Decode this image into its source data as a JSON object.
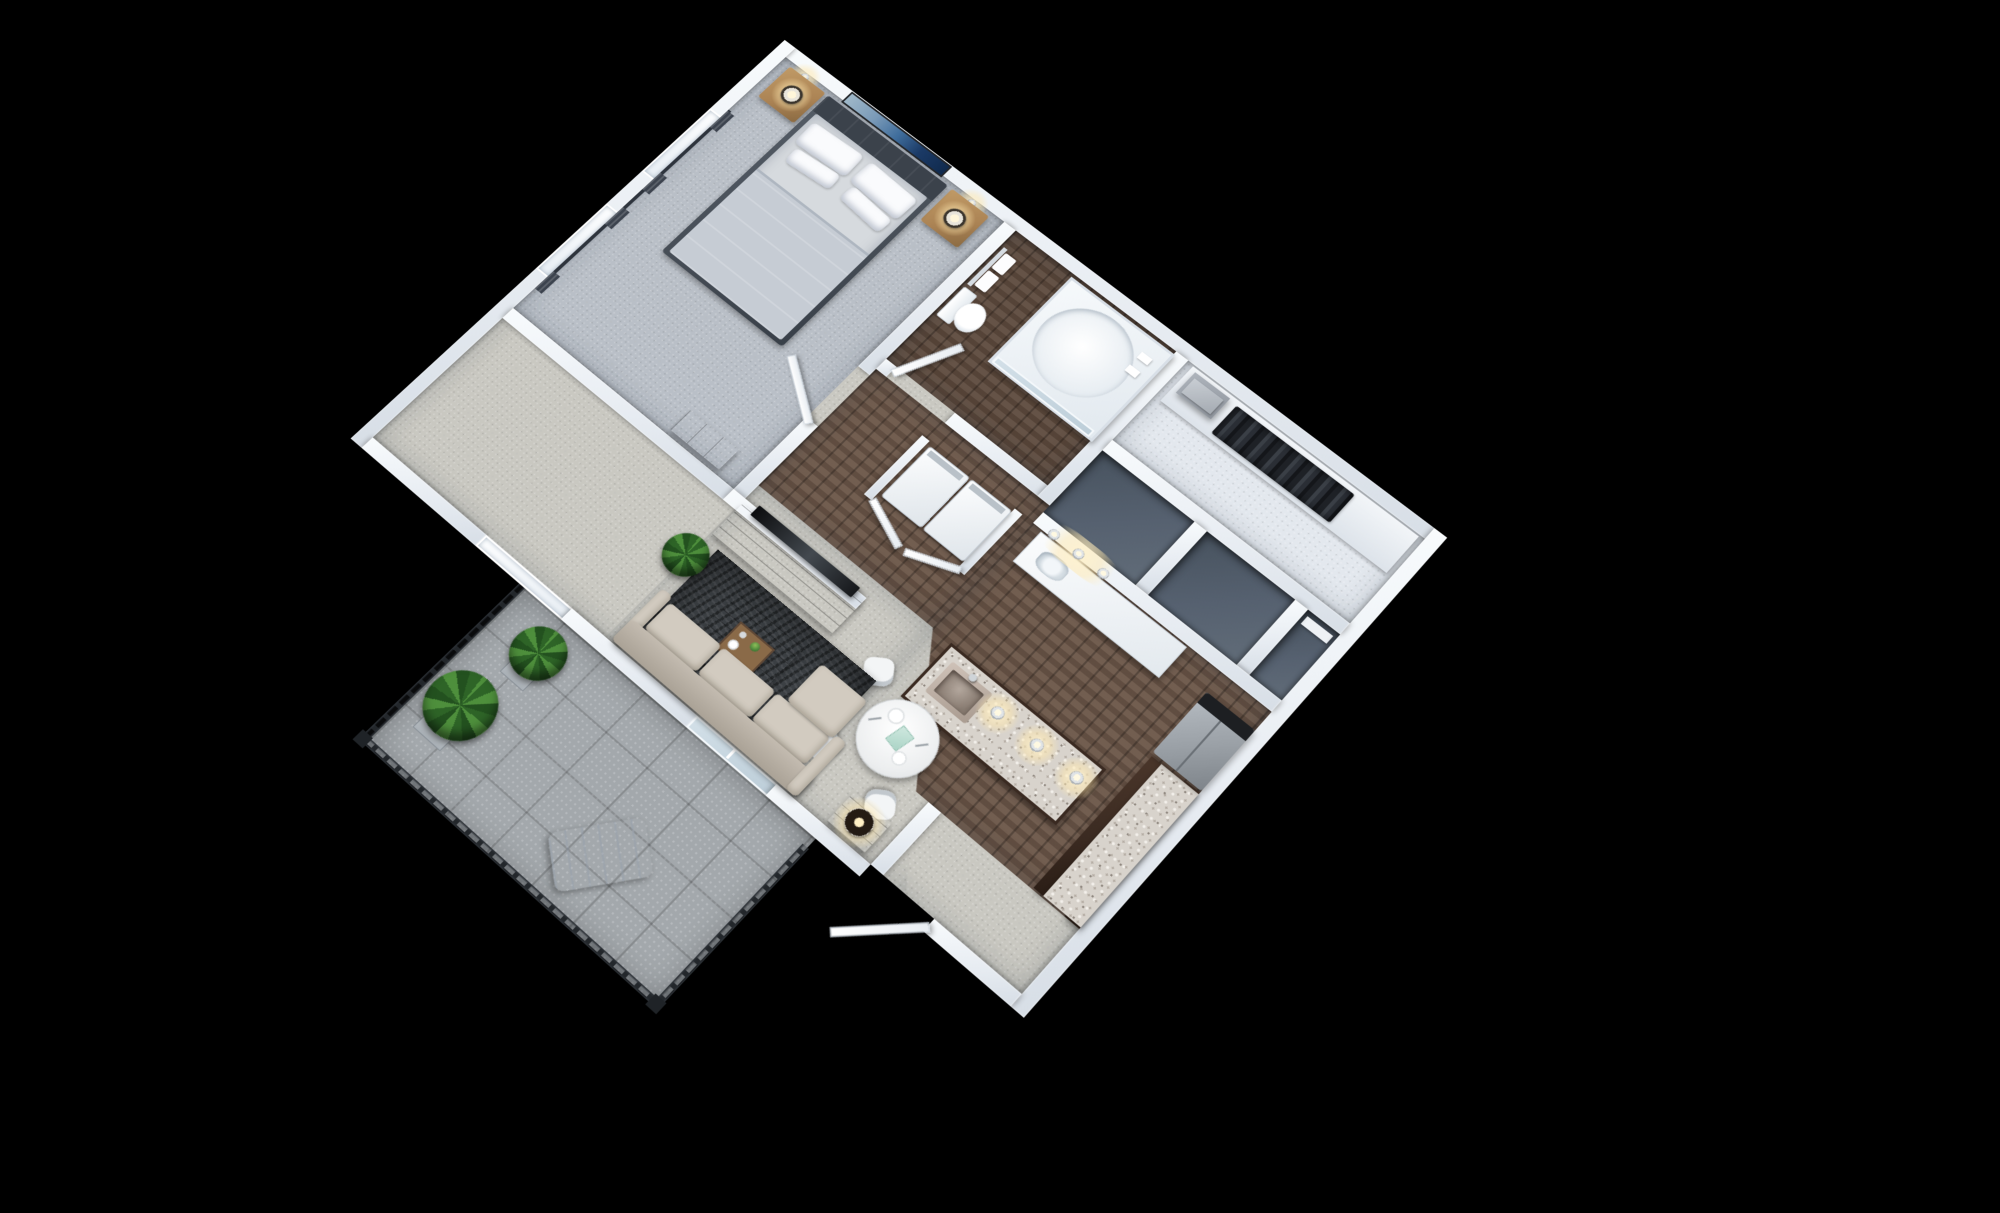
{
  "scene": {
    "type": "3d-isometric-floor-plan-render",
    "subject": "one-bedroom apartment with balcony",
    "background": "#000000",
    "view_angle": "elevated corner view, plan rotated ~42 degrees"
  },
  "palette": {
    "background": "#000000",
    "wall": "#e9edf2",
    "carpet_living": "#c9c8c1",
    "carpet_bedroom": "#b9bfc7",
    "wood_floor": "#6a5547",
    "wood_floor_dark": "#5d4a3d",
    "closet_floor": "#e3e8ee",
    "storage_floor": "#566170",
    "balcony_tile": "#a3a8ac",
    "rug": "#3c4044",
    "sofa": "#d2cbc0",
    "espresso_cabinet": "#3a2a21",
    "walnut_furniture": "#4a3226",
    "oak_wood": "#ab8354",
    "granite": "#d8d3cc",
    "fridge_steel": "#9aa0a6",
    "bed_frame": "#474e57",
    "mattress": "#d6dade",
    "blanket": "#c6ccd4",
    "artwork_sea": "#1b3a66",
    "artwork_sky": "#9fb8c9",
    "plant_green": "#3e7a34",
    "railing": "#2e3236",
    "curtain": "#3c434e",
    "lamp_glow": "#ffe9b8"
  },
  "rooms": [
    {
      "id": "bedroom",
      "floor": "carpet",
      "contents": [
        "queen-bed",
        "headboard",
        "pillows",
        "blanket",
        "nightstand-left",
        "nightstand-right",
        "table-lamp-left",
        "table-lamp-right",
        "wall-sconce-left",
        "wall-sconce-right",
        "seascape-artwork",
        "dresser",
        "curtained-window-upper",
        "curtained-window-lower",
        "balcony-window"
      ]
    },
    {
      "id": "bathroom",
      "floor": "wood",
      "contents": [
        "walk-in-shower",
        "shower-glass-door",
        "toilet",
        "towel-bar",
        "two-towels",
        "open-door"
      ]
    },
    {
      "id": "walk-in-closet",
      "floor": "carpet",
      "contents": [
        "hanging-clothes",
        "folded-linen-boxes",
        "shelf"
      ]
    },
    {
      "id": "storage-rooms",
      "floor": "dark",
      "contents": [
        "storage-a",
        "storage-b",
        "shelf-niche"
      ]
    },
    {
      "id": "hallway",
      "floor": "wood",
      "contents": [
        "vanity-counter",
        "vanity-sink",
        "three-vanity-bulbs",
        "laundry-closet",
        "washer",
        "dryer",
        "bifold-doors"
      ]
    },
    {
      "id": "kitchen",
      "floor": "wood",
      "contents": [
        "refrigerator",
        "espresso-wall-cabinets",
        "granite-counter-run",
        "island-with-granite-top",
        "undermount-sink",
        "pendant-light-1",
        "pendant-light-2",
        "pendant-light-3"
      ]
    },
    {
      "id": "dining-nook",
      "floor": "carpet",
      "contents": [
        "round-white-table",
        "three-molded-chairs",
        "two-place-settings",
        "mint-box-centerpiece"
      ]
    },
    {
      "id": "living-room",
      "floor": "carpet",
      "contents": [
        "charcoal-area-rug",
        "walnut-coffee-table",
        "serving-tray",
        "green-vase",
        "beige-sectional-sofa",
        "chaise",
        "walnut-side-table",
        "drum-lamp",
        "media-console",
        "flatscreen-tv",
        "potted-plant",
        "entry-door",
        "entry-vestibule"
      ]
    },
    {
      "id": "balcony",
      "floor": "tile",
      "contents": [
        "metal-railing-west",
        "metal-railing-south",
        "metal-railing-east",
        "potted-plant-small",
        "potted-plant-large",
        "white-lounge-chair",
        "sliding-glass-door"
      ]
    }
  ],
  "lighting": [
    "bedroom-sconces",
    "nightstand-lamps",
    "vanity-bulbs",
    "kitchen-pendants",
    "living-drum-lamp"
  ]
}
